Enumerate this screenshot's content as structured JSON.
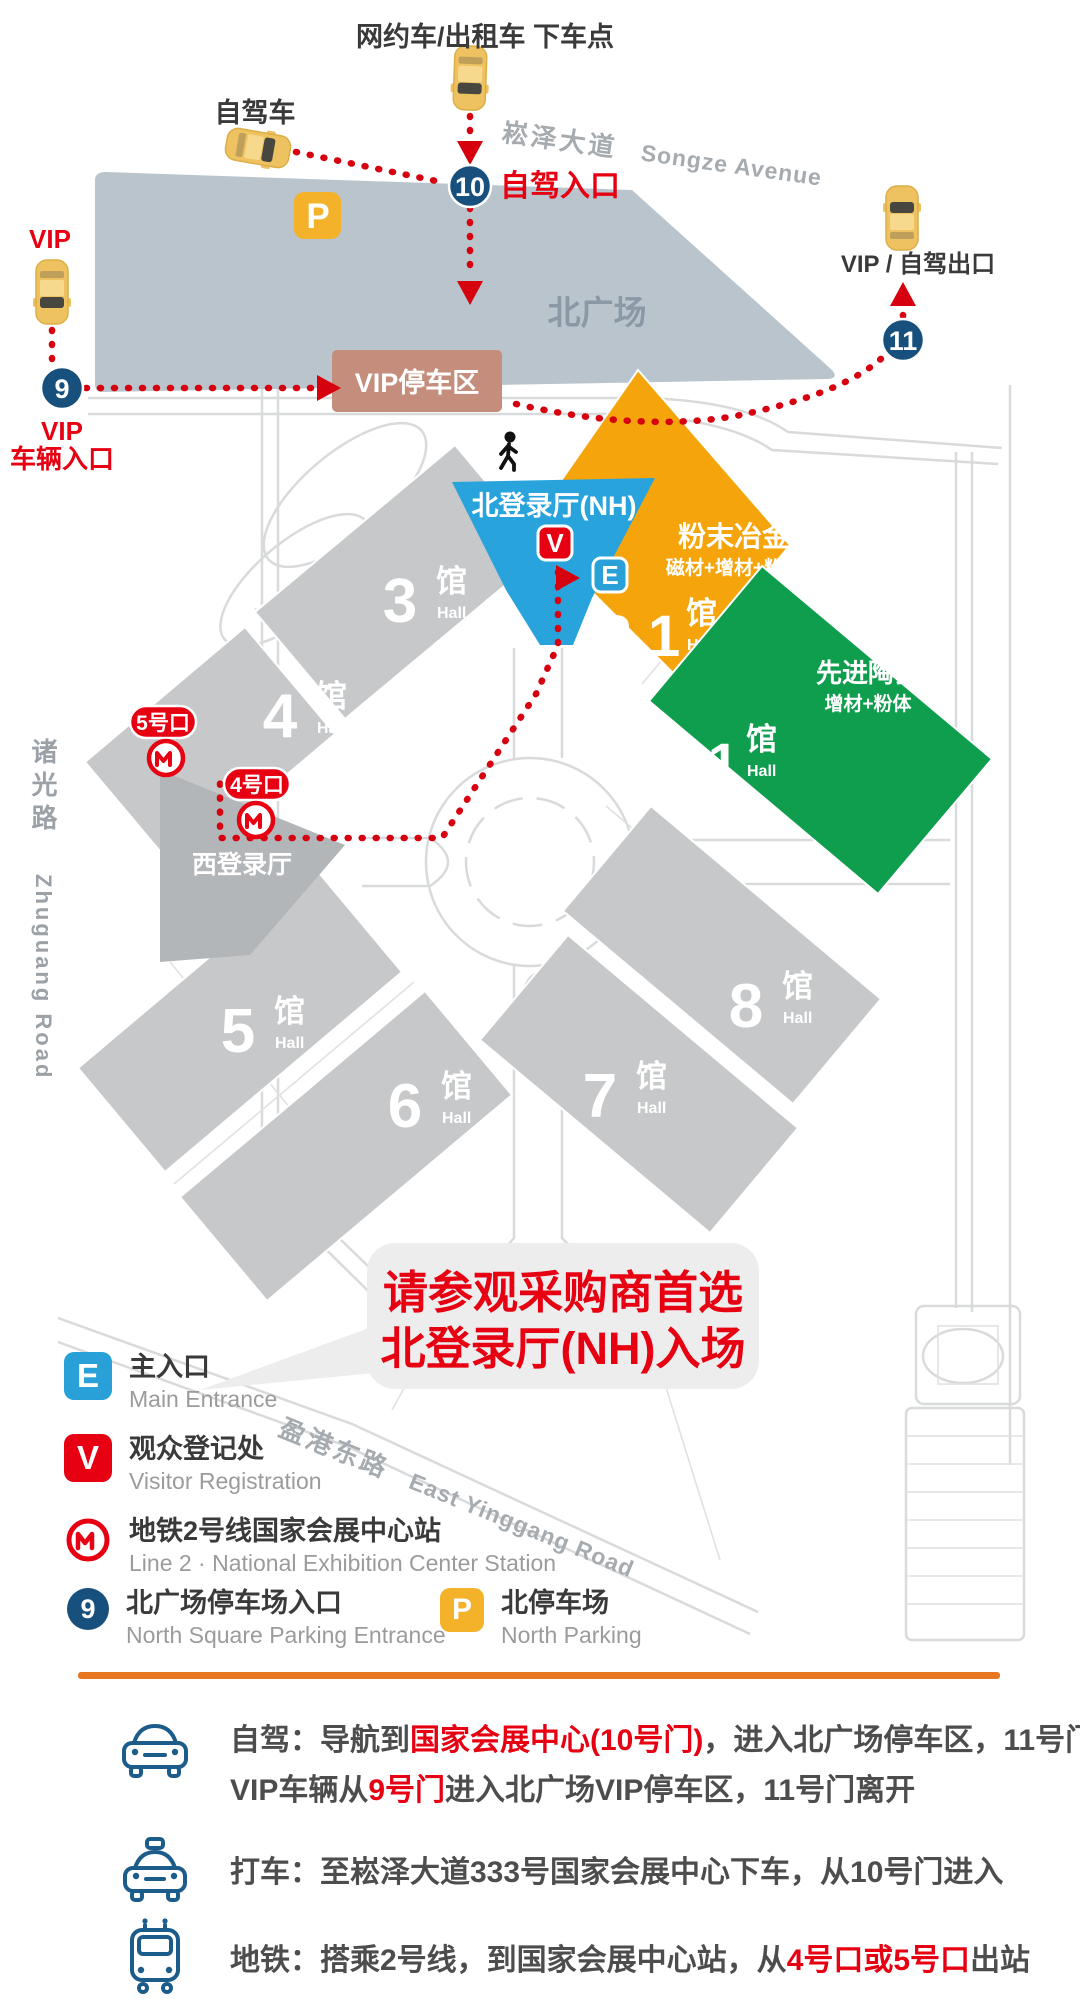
{
  "colors": {
    "red": "#e60012",
    "navy": "#17507c",
    "orange_hall": "#f5a50b",
    "green_hall": "#0f9d4e",
    "blue_lobby": "#29a3dc",
    "north_square_fill": "#b9c4cc",
    "vip_parking_fill": "#c58d7b",
    "hall_grey": "#c6c8ca",
    "divider_orange": "#e87722"
  },
  "map": {
    "labels": {
      "dropoff": "网约车/出租车 下车点",
      "self_drive": "自驾车",
      "songze_cn": "崧泽大道",
      "songze_en": "Songze Avenue",
      "self_drive_entrance": "自驾入口",
      "vip": "VIP",
      "vip_entrance_l1": "VIP",
      "vip_entrance_l2": "车辆入口",
      "vip_exit": "VIP / 自驾出口",
      "north_square": "北广场",
      "vip_parking": "VIP停车区",
      "zhuguang_cn": "诸光路",
      "zhuguang_en": "Zhuguang Road",
      "yinggang_cn": "盈港东路",
      "yinggang_en": "East Yinggang Road",
      "west_lobby": "西登录厅",
      "north_lobby": "北登录厅(NH)"
    },
    "badges": {
      "gate9": "9",
      "gate10": "10",
      "gate11": "11",
      "v": "V",
      "e": "E",
      "p": "P"
    },
    "metro_exits": {
      "exit5": "5号口",
      "exit4": "4号口"
    },
    "halls": [
      {
        "num": "3",
        "suffix": "馆",
        "en": "Hall"
      },
      {
        "num": "4",
        "suffix": "馆",
        "en": "Hall"
      },
      {
        "num": "5",
        "suffix": "馆",
        "en": "Hall"
      },
      {
        "num": "6",
        "suffix": "馆",
        "en": "Hall"
      },
      {
        "num": "7",
        "suffix": "馆",
        "en": "Hall"
      },
      {
        "num": "8",
        "suffix": "馆",
        "en": "Hall"
      }
    ],
    "featured_halls": [
      {
        "num": "2.1",
        "suffix": "馆",
        "en": "Hall",
        "title": "粉末冶金",
        "subtitle": "磁材+增材+粉体"
      },
      {
        "num": "1.1",
        "suffix": "馆",
        "en": "Hall",
        "title": "先进陶瓷",
        "subtitle": "增材+粉体"
      }
    ],
    "notice": {
      "line1": "请参观采购商首选",
      "line2": "北登录厅(NH)入场"
    }
  },
  "legend": {
    "items": [
      {
        "icon": "main-entrance",
        "symbol": "E",
        "label_cn": "主入口",
        "label_en": "Main Entrance"
      },
      {
        "icon": "visitor-registration",
        "symbol": "V",
        "label_cn": "观众登记处",
        "label_en": "Visitor Registration"
      },
      {
        "icon": "metro",
        "symbol": "",
        "label_cn": "地铁2号线国家会展中心站",
        "label_en": "Line 2 · National Exhibition Center Station"
      },
      {
        "icon": "gate9",
        "symbol": "9",
        "label_cn": "北广场停车场入口",
        "label_en": "North Square Parking Entrance"
      },
      {
        "icon": "parking",
        "symbol": "P",
        "label_cn": "北停车场",
        "label_en": "North Parking"
      }
    ]
  },
  "directions": {
    "rows": [
      {
        "icon": "car-icon",
        "lines": [
          [
            {
              "text": "自驾：导航到"
            },
            {
              "text": "国家会展中心(10号门)",
              "red": true
            },
            {
              "text": "，进入北广场停车区，11号门离开"
            }
          ],
          [
            {
              "text": "VIP车辆从"
            },
            {
              "text": "9号门",
              "red": true
            },
            {
              "text": "进入北广场VIP停车区，11号门离开"
            }
          ]
        ]
      },
      {
        "icon": "taxi-icon",
        "lines": [
          [
            {
              "text": "打车：至崧泽大道333号国家会展中心下车，从10号门进入"
            }
          ]
        ]
      },
      {
        "icon": "metro-icon",
        "lines": [
          [
            {
              "text": "地铁：搭乘2号线，到国家会展中心站，从"
            },
            {
              "text": "4号口或5号口",
              "red": true
            },
            {
              "text": "出站"
            }
          ]
        ]
      }
    ]
  }
}
